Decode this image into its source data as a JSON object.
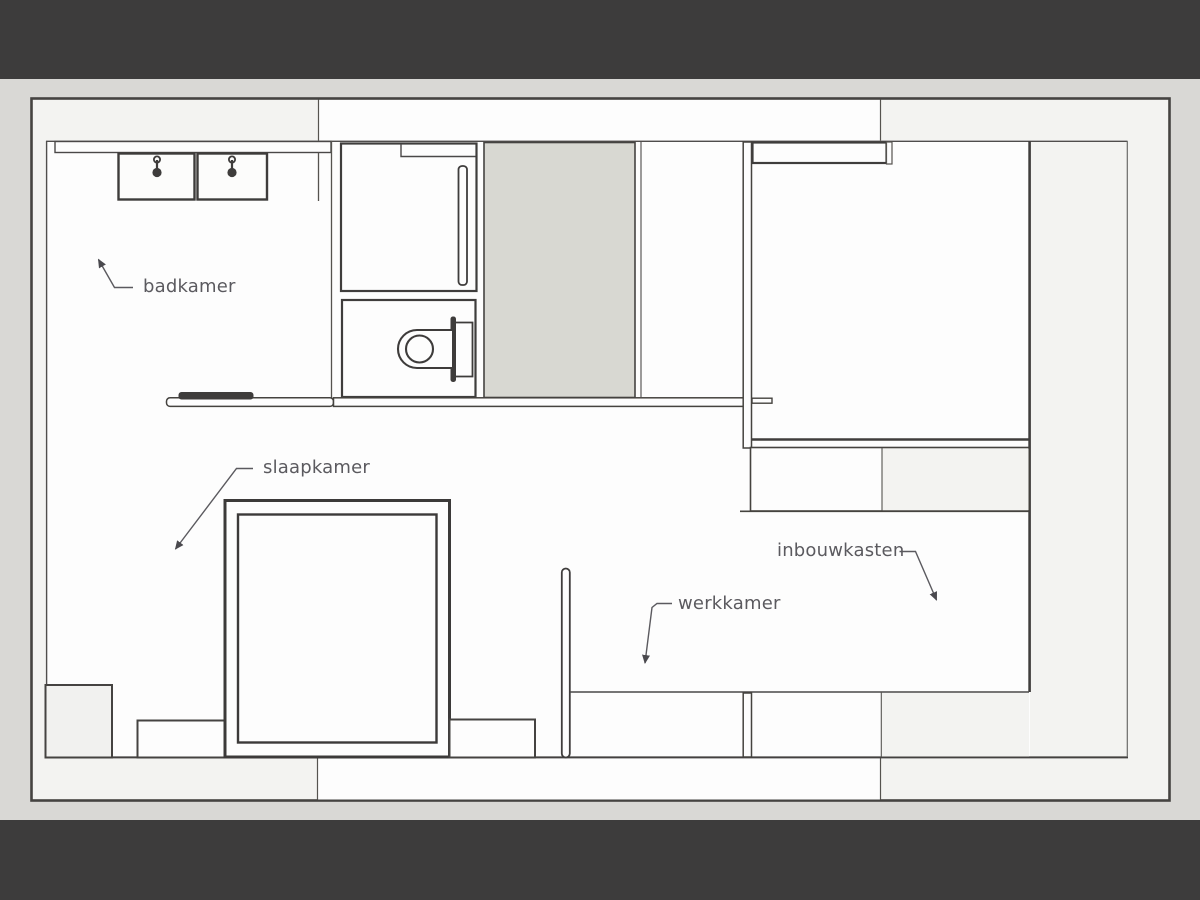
{
  "scene": {
    "kind": "apartment floor plan slide",
    "letterbox_color": "#3d3c3c",
    "page_background": "#d9d8d5"
  },
  "plan": {
    "outer_wall_fill": "#f3f3f1",
    "floor_fill": "#fdfdfd",
    "shaft_fill": "#d8d8d2",
    "cabinet_fill": "#f1f1ef",
    "wall_line_color": "#454341",
    "furniture_line_color": "#3e3c3b",
    "label_color": "#5b5a5f",
    "labels": {
      "badkamer": "badkamer",
      "slaapkamer": "slaapkamer",
      "werkkamer": "werkkamer",
      "inbouwkasten": "inbouwkasten"
    }
  }
}
